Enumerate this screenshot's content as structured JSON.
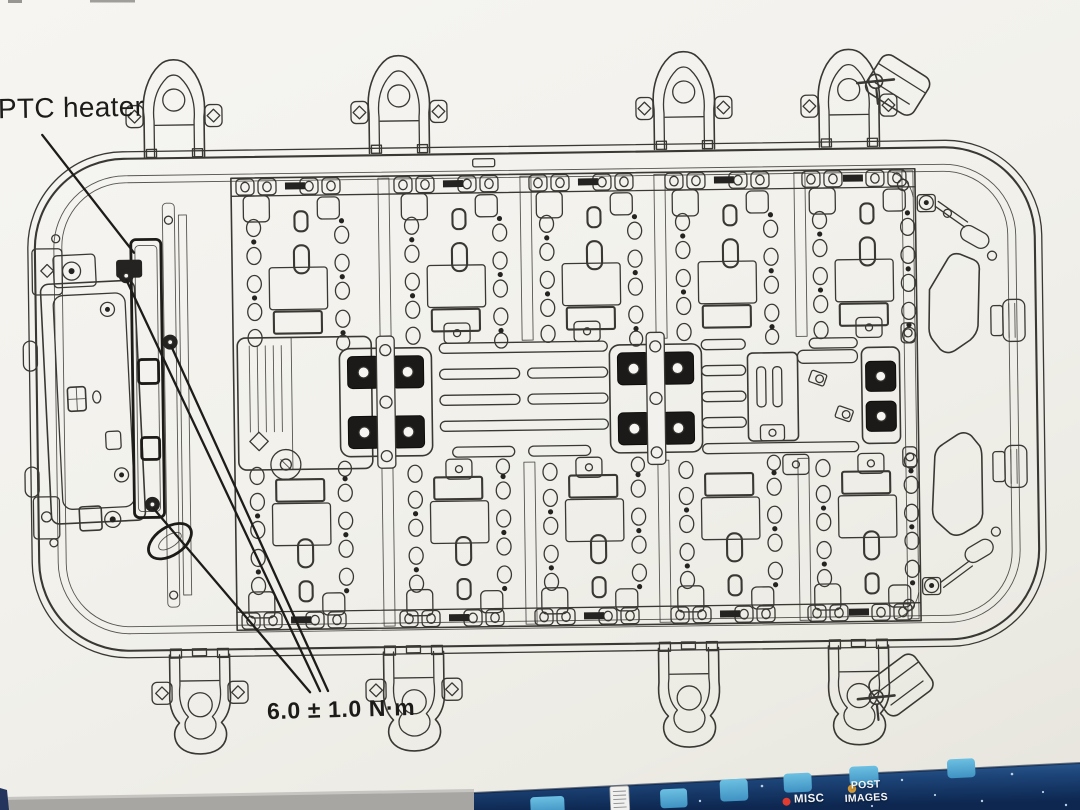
{
  "page": {
    "background_hex": "#f2f1ec",
    "line_hex": "#3a3833"
  },
  "diagram": {
    "name": "battery-pack-top-view",
    "labels": {
      "ptc": {
        "text": "PTC heater"
      },
      "torque": {
        "text": "6.0 ± 1.0 N·m"
      }
    }
  },
  "desktop": {
    "wallpaper_top_hex": "#2e5f9e",
    "wallpaper_bottom_hex": "#0d2750",
    "folder_hex": "#55aed8",
    "items": [
      {
        "label": "MISC",
        "tag_color_hex": "#e23b30"
      },
      {
        "label": "POST IMAGES",
        "tag_color_hex": "#d69a33"
      }
    ],
    "icons": [
      {
        "name": "folder-icon",
        "count": 7
      },
      {
        "name": "document-icon",
        "count": 1
      }
    ]
  }
}
